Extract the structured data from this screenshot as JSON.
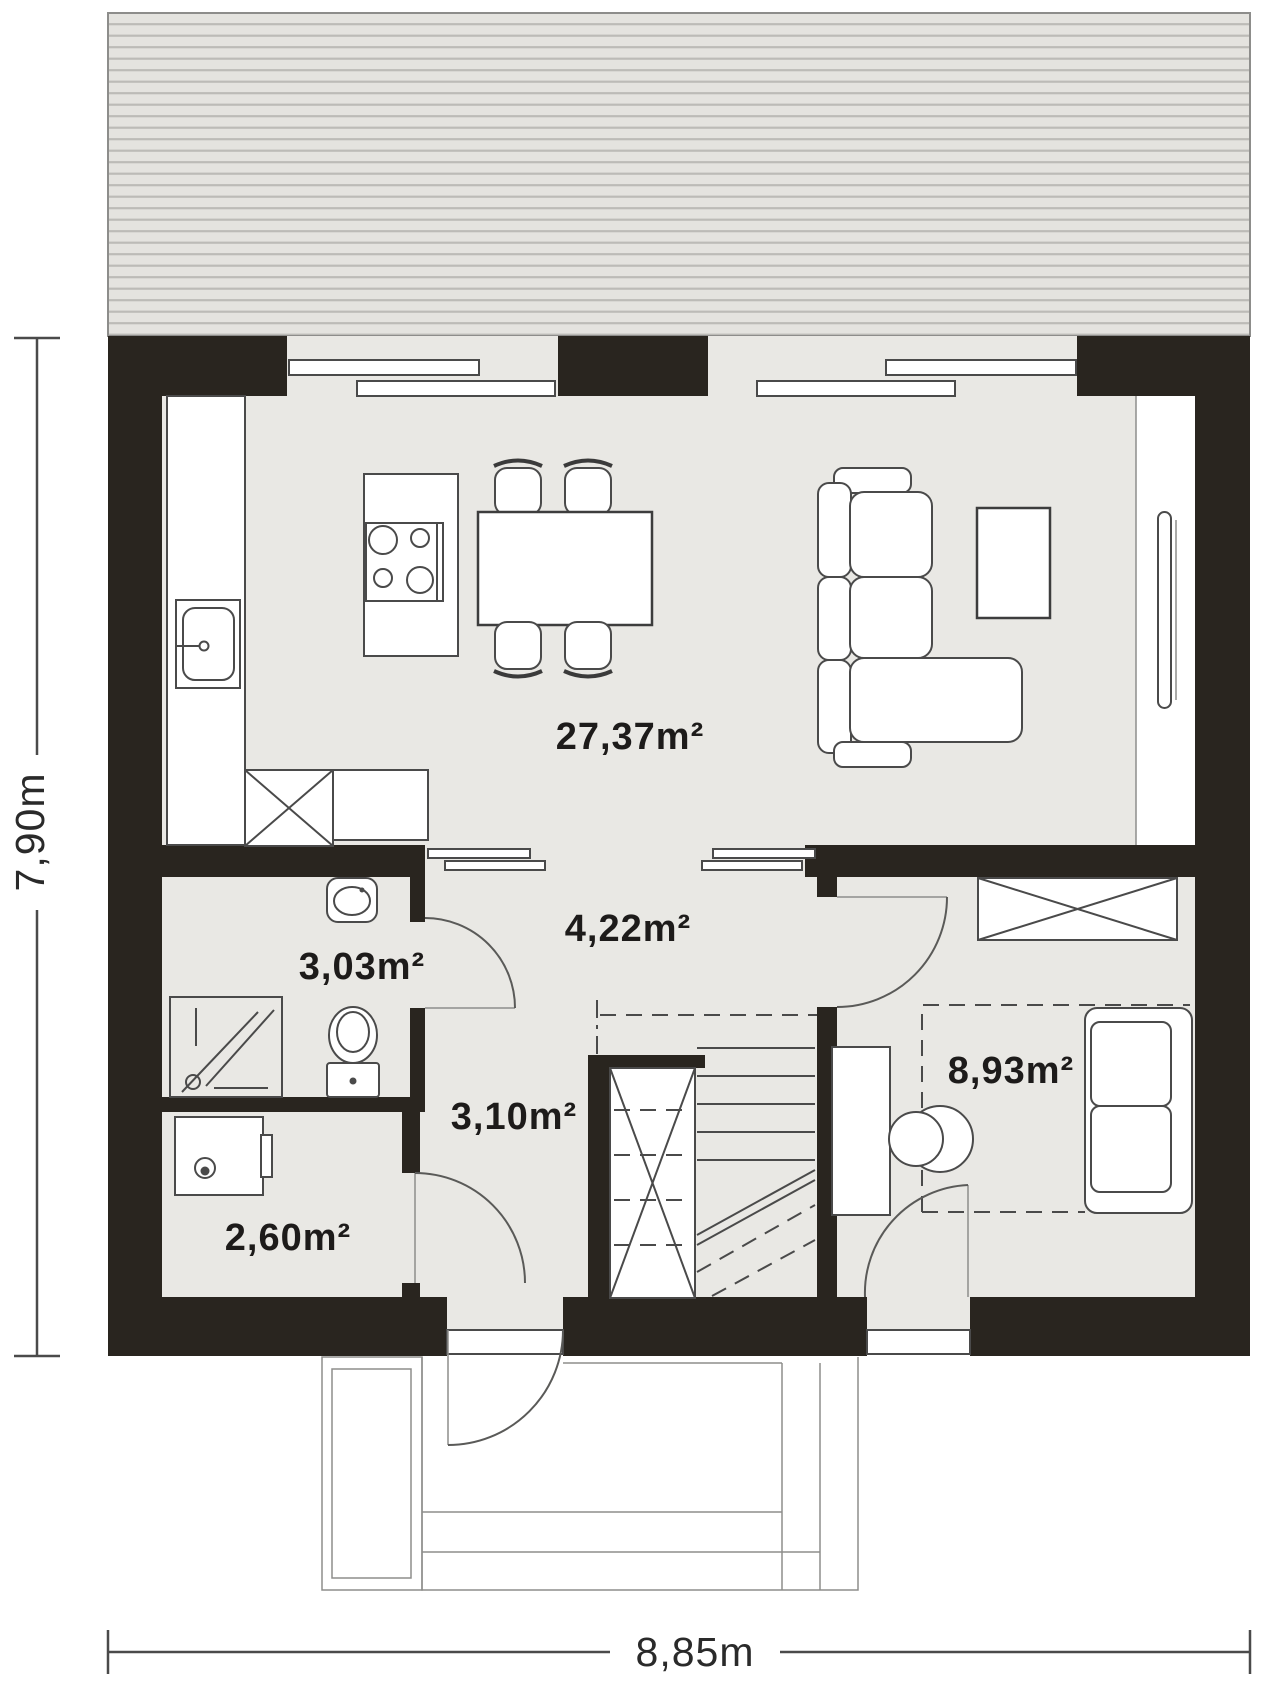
{
  "colors": {
    "wall": "#29251f",
    "floor": "#e9e8e4",
    "terrace_base": "#e4e3df",
    "terrace_stripe": "#bcbbb7",
    "white": "#ffffff",
    "outline": "#4a4a4a"
  },
  "rooms": {
    "living_kitchen": "27,37m²",
    "hall": "4,22m²",
    "bathroom": "3,03m²",
    "vestibule": "3,10m²",
    "utility": "2,60m²",
    "bedroom": "8,93m²"
  },
  "dimensions": {
    "total_width": "8,85m",
    "total_height": "7,90m"
  }
}
